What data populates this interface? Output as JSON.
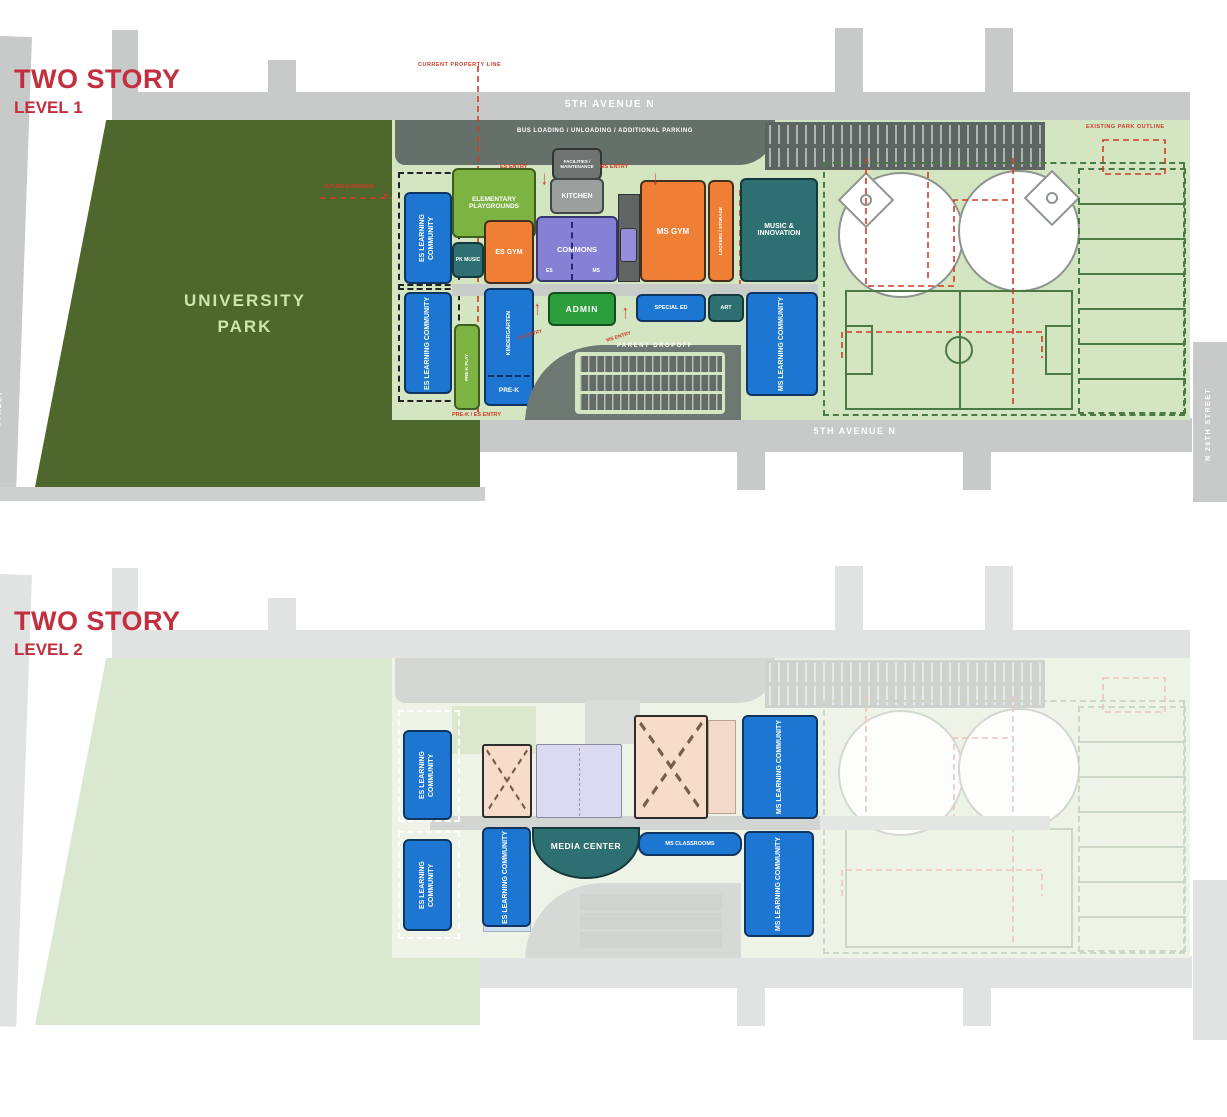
{
  "icons": {
    "arrow_up": "↑",
    "arrow_down": "↓",
    "arrow_right": "➤"
  },
  "colors": {
    "title_red": "#c22f3e",
    "annotation_red": "#cf3b2a",
    "park_green": "#4d672d",
    "campus_green": "#d3e5c1",
    "building_blue": "#1d76d2",
    "building_orange": "#ef7f35",
    "building_purple": "#8781d6",
    "building_teal": "#2e6f71",
    "admin_green": "#2d9e3d",
    "playground_green": "#7cb342",
    "street_gray": "#c7cac8",
    "road_dark_gray": "#6e7873",
    "level2_peach": "#f7dcca",
    "level2_lavender": "#dcdaf0"
  },
  "level1": {
    "title": "TWO STORY",
    "subtitle": "LEVEL 1",
    "park": "UNIVERSITY PARK",
    "streets": {
      "top": "5TH AVENUE N",
      "bottom": "5TH AVENUE N",
      "left": "N 35TH STREET",
      "right": "N 26TH STREET"
    },
    "roads": {
      "bus": "BUS LOADING / UNLOADING / ADDITIONAL PARKING",
      "dropoff": "PARENT DROPOFF"
    },
    "annotations": {
      "property_line": "CURRENT PROPERTY LINE",
      "existing_park": "EXISTING PARK OUTLINE",
      "es_entry": "ES ENTRY",
      "ms_entry": "MS ENTRY",
      "prek_entry": "PRE-K / ES ENTRY",
      "future": "FUTURE EXPANSION"
    },
    "buildings": {
      "es_lc_upper": "ES LEARNING COMMUNITY",
      "es_lc_lower": "ES LEARNING COMMUNITY",
      "playgrounds": "ELEMENTARY PLAYGROUNDS",
      "pk_music": "PK MUSIC",
      "es_gym": "ES GYM",
      "facilities": "FACILITIES / MAINTENANCE",
      "kitchen": "KITCHEN",
      "commons": "COMMONS",
      "commons_es": "ES",
      "commons_ms": "MS",
      "ms_gym": "MS GYM",
      "lockers": "LOCKERS / STORAGE",
      "music": "MUSIC & INNOVATION",
      "admin": "ADMIN",
      "special_ed": "SPECIAL ED",
      "art": "ART",
      "ms_lc": "MS LEARNING COMMUNITY",
      "kindergarten": "KINDERGARTEN",
      "pre_k": "PRE-K",
      "prek_play": "PRE-K PLAY"
    }
  },
  "level2": {
    "title": "TWO STORY",
    "subtitle": "LEVEL 2",
    "buildings": {
      "es_lc_top": "ES LEARNING COMMUNITY",
      "ms_lc_top": "MS LEARNING COMMUNITY",
      "es_lc_bottom_left": "ES LEARNING COMMUNITY",
      "es_lc_bottom_mid": "ES LEARNING COMMUNITY",
      "media_center": "MEDIA CENTER",
      "ms_classrooms": "MS CLASSROOMS",
      "ms_lc_bottom": "MS LEARNING COMMUNITY"
    }
  }
}
